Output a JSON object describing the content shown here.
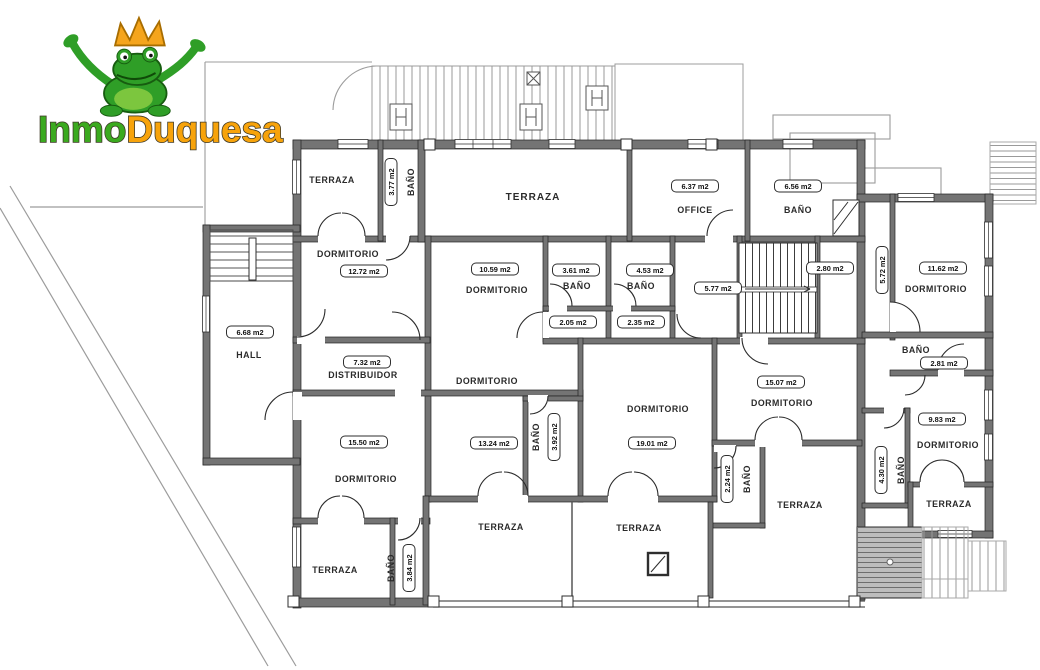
{
  "logo": {
    "part1": "Inmo",
    "part2": "Duquesa"
  },
  "colors": {
    "logo_green": "#3BAA1F",
    "logo_orange": "#F7A30B",
    "wall_gray": "#747474"
  },
  "rooms": [
    {
      "label": "TERRAZA",
      "area": ""
    },
    {
      "label": "BAÑO",
      "area": "3.77 m2"
    },
    {
      "label": "DORMITORIO",
      "area": "12.72 m2"
    },
    {
      "label": "TERRAZA",
      "area": ""
    },
    {
      "label": "OFFICE",
      "area": "6.37 m2"
    },
    {
      "label": "BAÑO",
      "area": "6.56 m2"
    },
    {
      "label": "DORMITORIO",
      "area": "10.59 m2"
    },
    {
      "label": "BAÑO",
      "area": "3.61 m2"
    },
    {
      "label": "BAÑO",
      "area": "4.53 m2"
    },
    {
      "label": "",
      "area": "5.77 m2"
    },
    {
      "label": "",
      "area": "2.80 m2"
    },
    {
      "label": "",
      "area": "5.72 m2"
    },
    {
      "label": "DORMITORIO",
      "area": "11.62 m2"
    },
    {
      "label": "HALL",
      "area": "6.68 m2"
    },
    {
      "label": "DISTRIBUIDOR",
      "area": "7.32 m2"
    },
    {
      "label": "",
      "area": "2.05 m2"
    },
    {
      "label": "",
      "area": "2.35 m2"
    },
    {
      "label": "DORMITORIO",
      "area": "13.24 m2"
    },
    {
      "label": "BAÑO",
      "area": "3.92 m2"
    },
    {
      "label": "DORMITORIO",
      "area": "19.01 m2"
    },
    {
      "label": "DORMITORIO",
      "area": "15.07 m2"
    },
    {
      "label": "BAÑO",
      "area": "2.81 m2"
    },
    {
      "label": "DORMITORIO",
      "area": "9.83 m2"
    },
    {
      "label": "BAÑO",
      "area": "2.24 m2"
    },
    {
      "label": "BAÑO",
      "area": "4.30 m2"
    },
    {
      "label": "DORMITORIO",
      "area": "15.50 m2"
    },
    {
      "label": "BAÑO",
      "area": "3.84 m2"
    },
    {
      "label": "TERRAZA",
      "area": ""
    },
    {
      "label": "TERRAZA",
      "area": ""
    },
    {
      "label": "TERRAZA",
      "area": ""
    },
    {
      "label": "TERRAZA",
      "area": ""
    },
    {
      "label": "TERRAZA",
      "area": ""
    }
  ]
}
